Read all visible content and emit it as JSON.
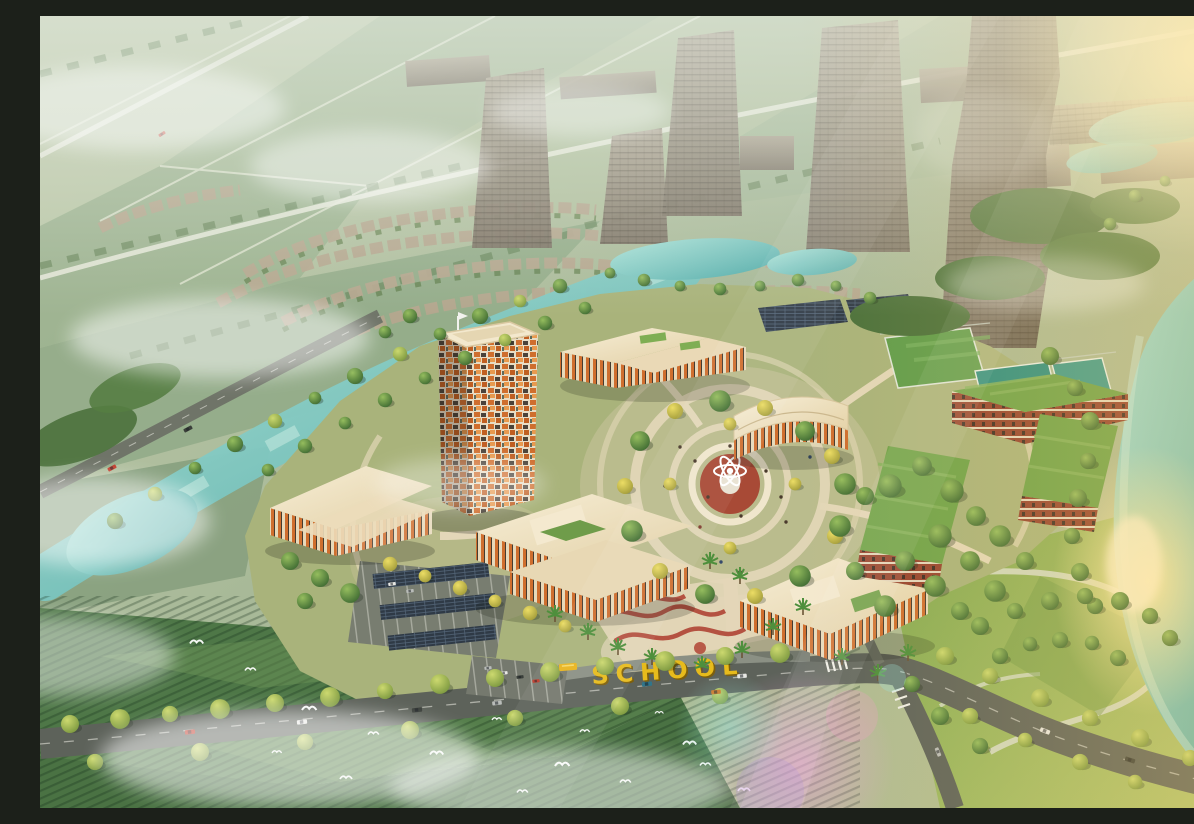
{
  "scene": {
    "title": "Golden-hour aerial rendering of a landscaped school campus masterplan surrounded by farmland, canals and future ghosted developments",
    "type": "architectural-visualization",
    "time_of_day": "golden hour",
    "signage": {
      "school_sign_text": "SCHOOL",
      "color": "#e7bb1c"
    },
    "palette": {
      "water": "#66b8b2",
      "water_light": "#a8e0d6",
      "lawn": "#a9b37b",
      "park_green": "#8cb055",
      "roof_cream": "#efe2c2",
      "facade_orange": "#cf6e2e",
      "brick_red": "#96432f",
      "green_roof": "#6fa34a",
      "road": "#5d625a",
      "pavement": "#e3d7b8",
      "plaza_red": "#a84a36",
      "court_teal": "#2e8f82",
      "court_blue": "#3f9b8d",
      "ghost_gray": "#968c7c",
      "tree_dark": "#3e6a33",
      "tree_light": "#8cb457",
      "tree_yellow": "#cfc14d",
      "sun_gold": "#f7cd6e",
      "fog_white": "#ffffff"
    },
    "landmarks": {
      "campus": [
        "mosaic-facade tower",
        "north classroom block",
        "curved auditorium",
        "west multipurpose hall",
        "southwest courtyard school building",
        "southeast courtyard school building",
        "brick dormitory blocks with green roofs",
        "central circular plaza with fountain sculpture",
        "tennis and basketball courts",
        "football pitch",
        "solar carport parking",
        "red playground plaza"
      ],
      "context": [
        "ghosted future high-rise towers",
        "ghosted mega tower",
        "ghosted townhouse rows",
        "turquoise canal and ponds",
        "river with golden sun reflection",
        "farmland and rice paddies",
        "tree-lined boulevard with cars and yellow school bus",
        "flock of white birds",
        "morning fog patches",
        "lens flare"
      ]
    }
  }
}
